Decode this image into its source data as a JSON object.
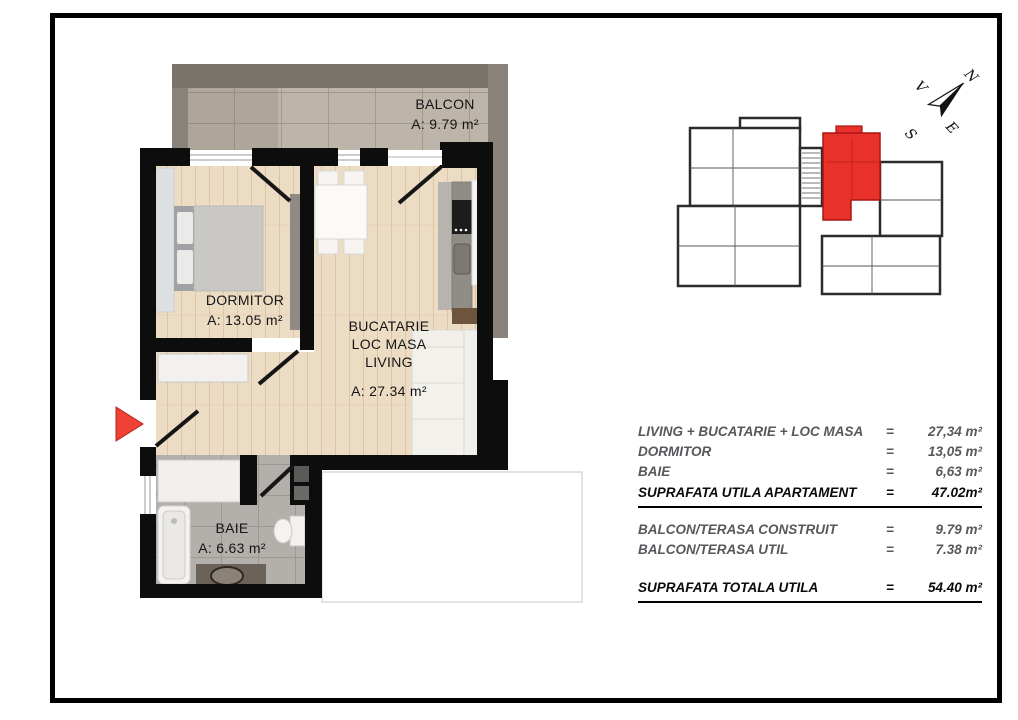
{
  "rooms": {
    "balcon": {
      "title": "BALCON",
      "area": "A: 9.79 m²"
    },
    "dormitor": {
      "title": "DORMITOR",
      "area": "A: 13.05 m²"
    },
    "living": {
      "line1": "BUCATARIE",
      "line2": "LOC MASA",
      "line3": "LIVING",
      "area": "A: 27.34 m²"
    },
    "baie": {
      "title": "BAIE",
      "area": "A: 6.63 m²"
    }
  },
  "compass": {
    "n": "N",
    "e": "E",
    "s": "S",
    "v": "V"
  },
  "colors": {
    "accent_red": "#e8312b",
    "wall_black": "#0d0d0d",
    "wood_floor": "#ecdcc4",
    "bath_tile": "#b3b0ab",
    "balcony_floor": "#beb5aa"
  },
  "area_table": {
    "rows": [
      {
        "label": "LIVING + BUCATARIE + LOC MASA",
        "eq": "=",
        "value": "27,34 m²"
      },
      {
        "label": "DORMITOR",
        "eq": "=",
        "value": "13,05 m²"
      },
      {
        "label": "BAIE",
        "eq": "=",
        "value": "6,63 m²"
      },
      {
        "label": "SUPRAFATA UTILA APARTAMENT",
        "eq": "=",
        "value": "47.02m²"
      },
      {
        "label": "BALCON/TERASA CONSTRUIT",
        "eq": "=",
        "value": "9.79 m²"
      },
      {
        "label": "BALCON/TERASA UTIL",
        "eq": "=",
        "value": "7.38 m²"
      },
      {
        "label": "SUPRAFATA TOTALA UTILA",
        "eq": "=",
        "value": "54.40 m²"
      }
    ]
  }
}
